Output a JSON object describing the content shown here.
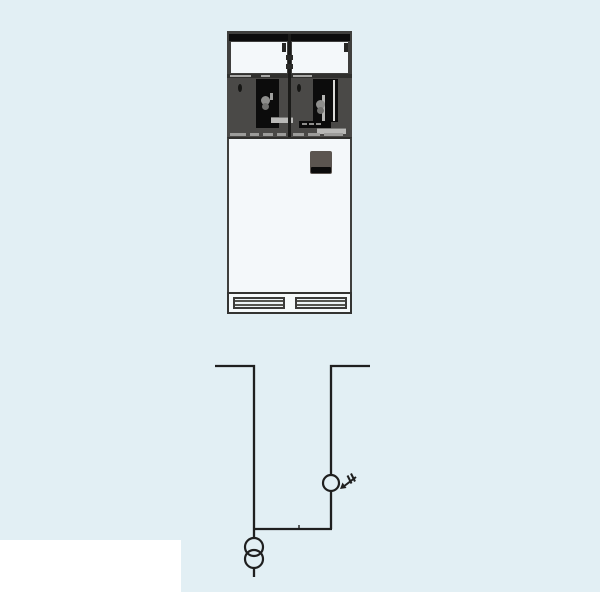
{
  "page": {
    "type": "catalog-figure",
    "description": "Medium-voltage switchgear panel: front photograph of the cabinet shown above its one-line circuit diagram on a pale-blue panel"
  },
  "colors": {
    "page-bg": "#ffffff",
    "panel-bg": "#e2eff4",
    "ink": "#1f1f1f",
    "frame": "#3f3f3d",
    "dark": "#4a4947",
    "black": "#0c0c0c",
    "white": "#f4f8fa",
    "metal": "#b9b9b7",
    "metal-mid": "#8e8e8c",
    "plate": "#5b5550"
  },
  "cabinet": {
    "label": "switchgear-cabinet-front-photo",
    "sections": {
      "top_frame": "steel top frame with black rail and two white inspection windows separated by a center divider",
      "mechanism": "two dark operating-mechanism compartments, each with a black switch window, operating shaft knobs, a round keyhole and metal bars; right compartment carries a black nameplate strip",
      "door": "white front door with a small dark indicator plate at upper right",
      "base": "cabinet base with two horizontal ventilation grilles"
    }
  },
  "diagram": {
    "type": "single-line-circuit-diagram",
    "components": [
      {
        "id": "left-feeder",
        "symbol": "busbar-riser",
        "position": "left, drops from top busbar stub down to bottom tie"
      },
      {
        "id": "right-feeder",
        "symbol": "busbar-riser",
        "position": "right, drops from top busbar stub down to bottom tie"
      },
      {
        "id": "indicator",
        "symbol": "circle-with-plug-arrow",
        "on": "right-feeder",
        "meaning": "measuring/indicator point with plug-in cable connection arrow"
      },
      {
        "id": "tie",
        "symbol": "bottom-connector-line",
        "connects": [
          "left-feeder",
          "right-feeder"
        ]
      },
      {
        "id": "transformer",
        "symbol": "two-winding-transformer (two overlapping circles)",
        "on": "bottom of left feeder",
        "tail": "short line below"
      }
    ]
  }
}
